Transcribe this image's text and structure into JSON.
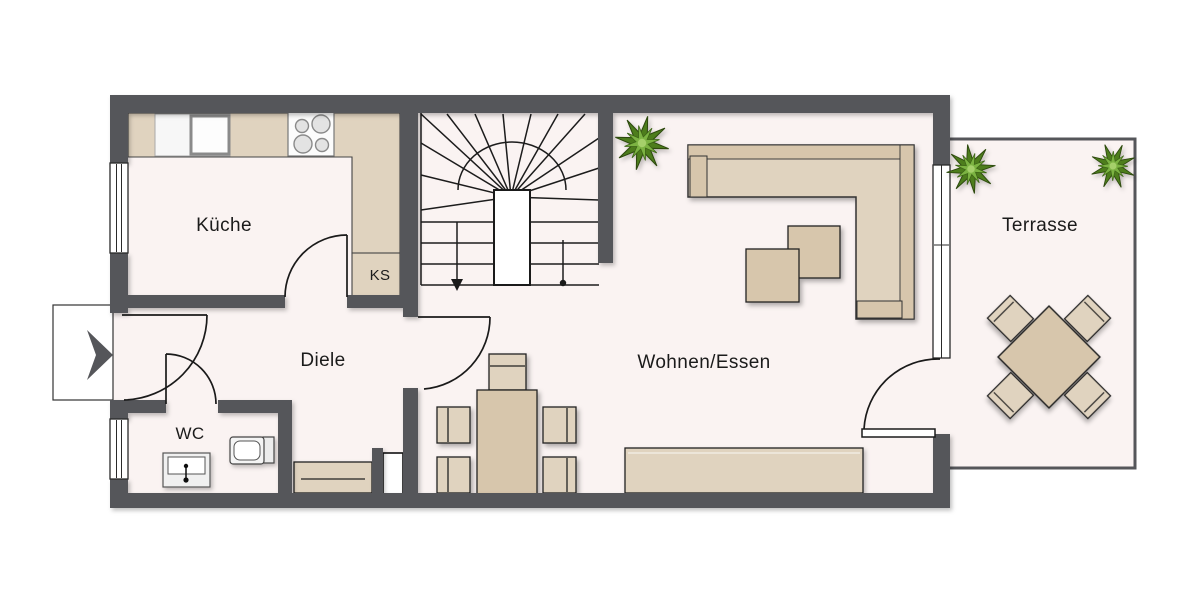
{
  "floorplan": {
    "labels": {
      "kitchen": "Küche",
      "fridge": "KS",
      "hall": "Diele",
      "wc": "WC",
      "living": "Wohnen/Essen",
      "terrace": "Terrasse"
    },
    "icons": {
      "entrance_arrow": "entry-direction-arrow",
      "stair_walkline_arrow": "stair-down-arrow",
      "stair_walkline_start": "walkline-start-dot",
      "plant": "potted-plant"
    },
    "colors": {
      "wall": "#55565a",
      "floor": "#faf3f2",
      "furniture": "#e0d3bf",
      "furnitureDark": "#d7c6ac",
      "line": "#222222",
      "plantDark": "#4e7d1e",
      "plantLight": "#7cb342"
    }
  }
}
